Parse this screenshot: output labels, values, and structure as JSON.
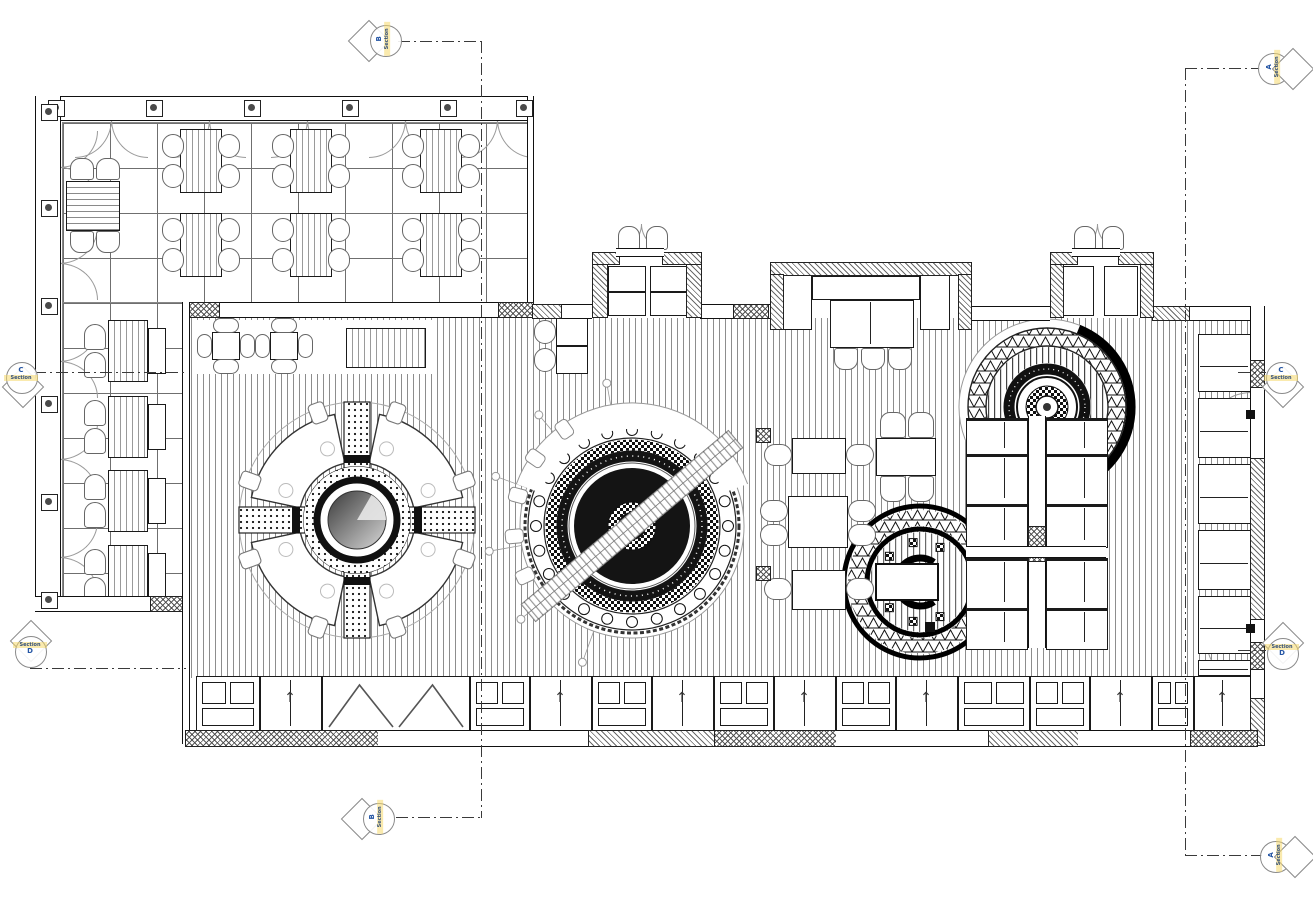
{
  "drawing": {
    "kind": "architectural floor plan",
    "colors": {
      "paper": "#ffffff",
      "ink": "#1a1a1a",
      "line_gray": "#8a8a8a",
      "hatch_gray": "#5a5a5a",
      "marker_blue": "#2455a4",
      "marker_orange": "#c8731f",
      "highlight_yellow": "#f5d96b"
    }
  },
  "sections": {
    "top": {
      "word": "Section",
      "letter": "B"
    },
    "bottom": {
      "word": "Section",
      "letter": "B"
    },
    "right_top": {
      "word": "Section",
      "letter": "A"
    },
    "right_bottom": {
      "word": "Section",
      "letter": "A"
    },
    "left_c": {
      "word": "Section",
      "letter": "C"
    },
    "right_c": {
      "word": "Section",
      "letter": "C"
    },
    "left_d": {
      "word": "Section",
      "letter": "D"
    },
    "right_d": {
      "word": "Section",
      "letter": "D"
    }
  }
}
